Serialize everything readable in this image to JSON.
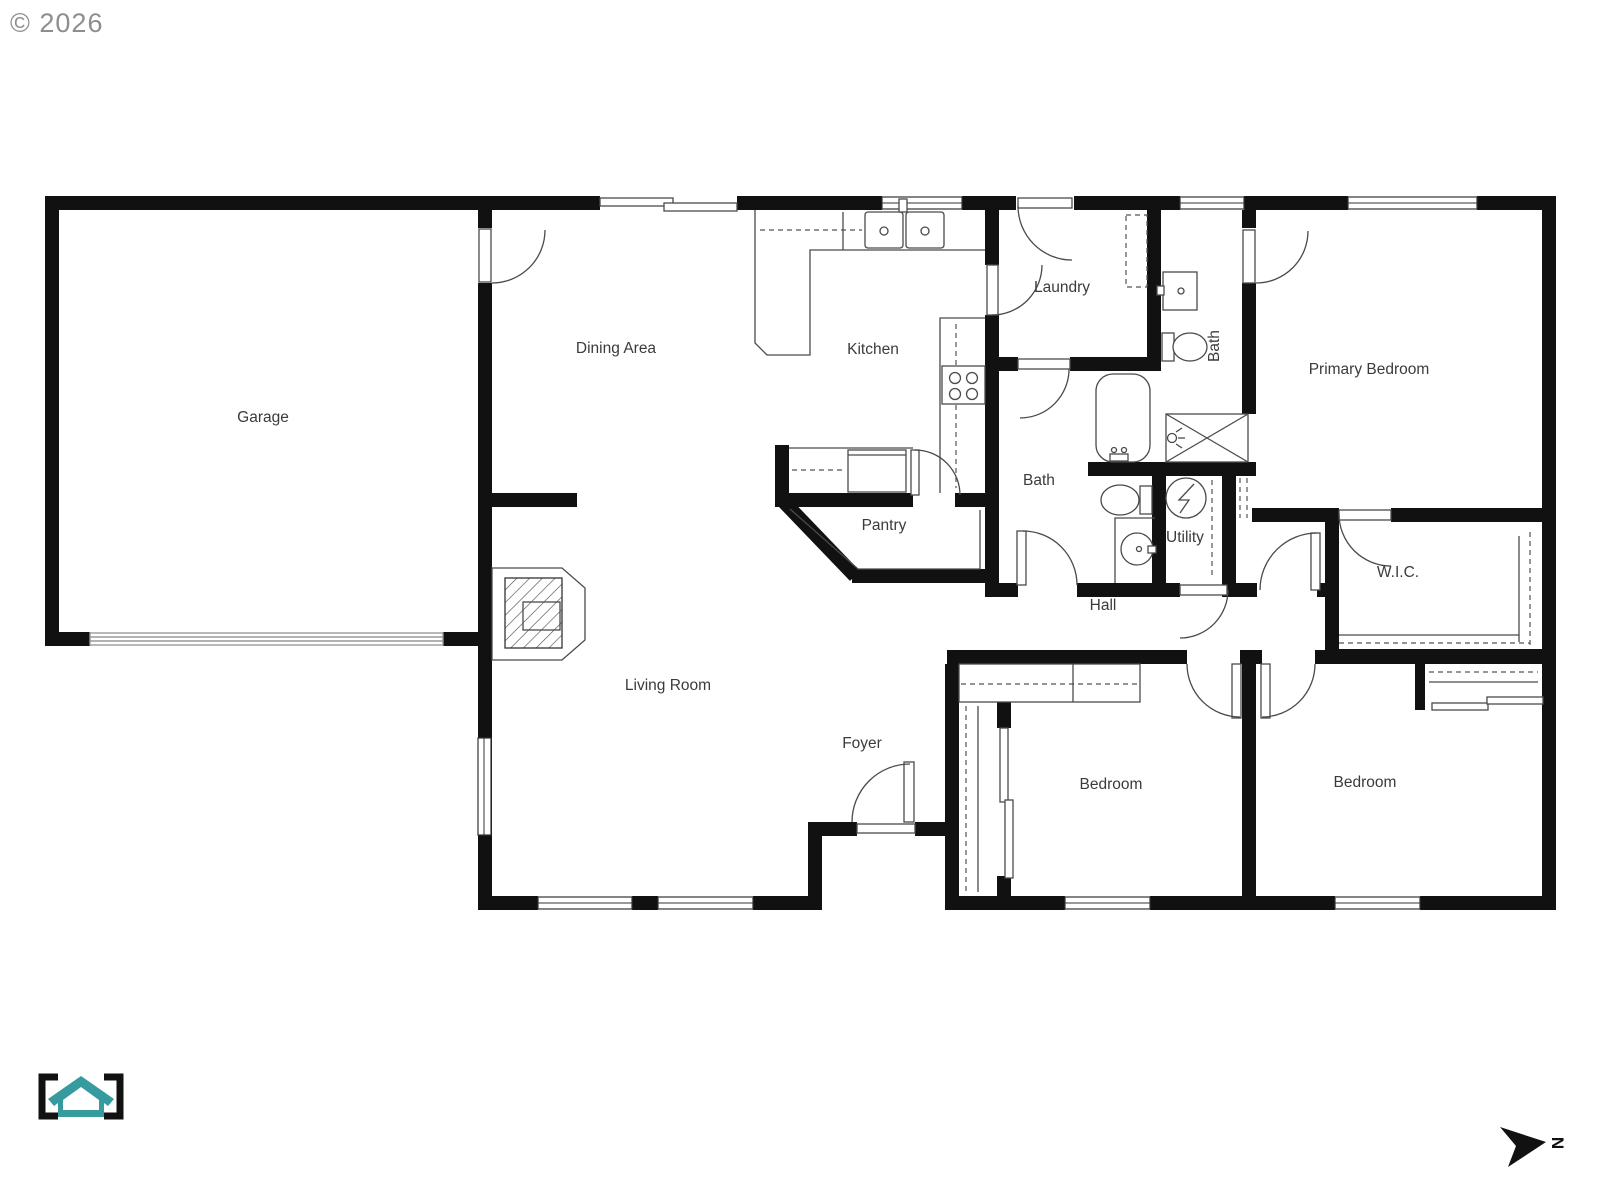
{
  "page": {
    "copyright": "© 2026"
  },
  "compass": {
    "north_label": "N"
  },
  "logo": {
    "name": "bracketed-house-logo",
    "color": "#359b9e"
  },
  "colors": {
    "background": "#ffffff",
    "wall": "#111111",
    "fixture_line": "#4a4a4a",
    "label_text": "#3b3b3b",
    "copyright_text": "#8e8e8e",
    "garage_door_line": "#999999"
  },
  "rooms": {
    "garage": {
      "label": "Garage"
    },
    "dining": {
      "label": "Dining Area"
    },
    "kitchen": {
      "label": "Kitchen"
    },
    "laundry": {
      "label": "Laundry"
    },
    "bath_upper": {
      "label": "Bath"
    },
    "primary_bedroom": {
      "label": "Primary Bedroom"
    },
    "bath_lower": {
      "label": "Bath"
    },
    "pantry": {
      "label": "Pantry"
    },
    "utility": {
      "label": "Utility"
    },
    "hall": {
      "label": "Hall"
    },
    "wic": {
      "label": "W.I.C."
    },
    "living": {
      "label": "Living Room"
    },
    "foyer": {
      "label": "Foyer"
    },
    "bedroom_left": {
      "label": "Bedroom"
    },
    "bedroom_right": {
      "label": "Bedroom"
    }
  }
}
